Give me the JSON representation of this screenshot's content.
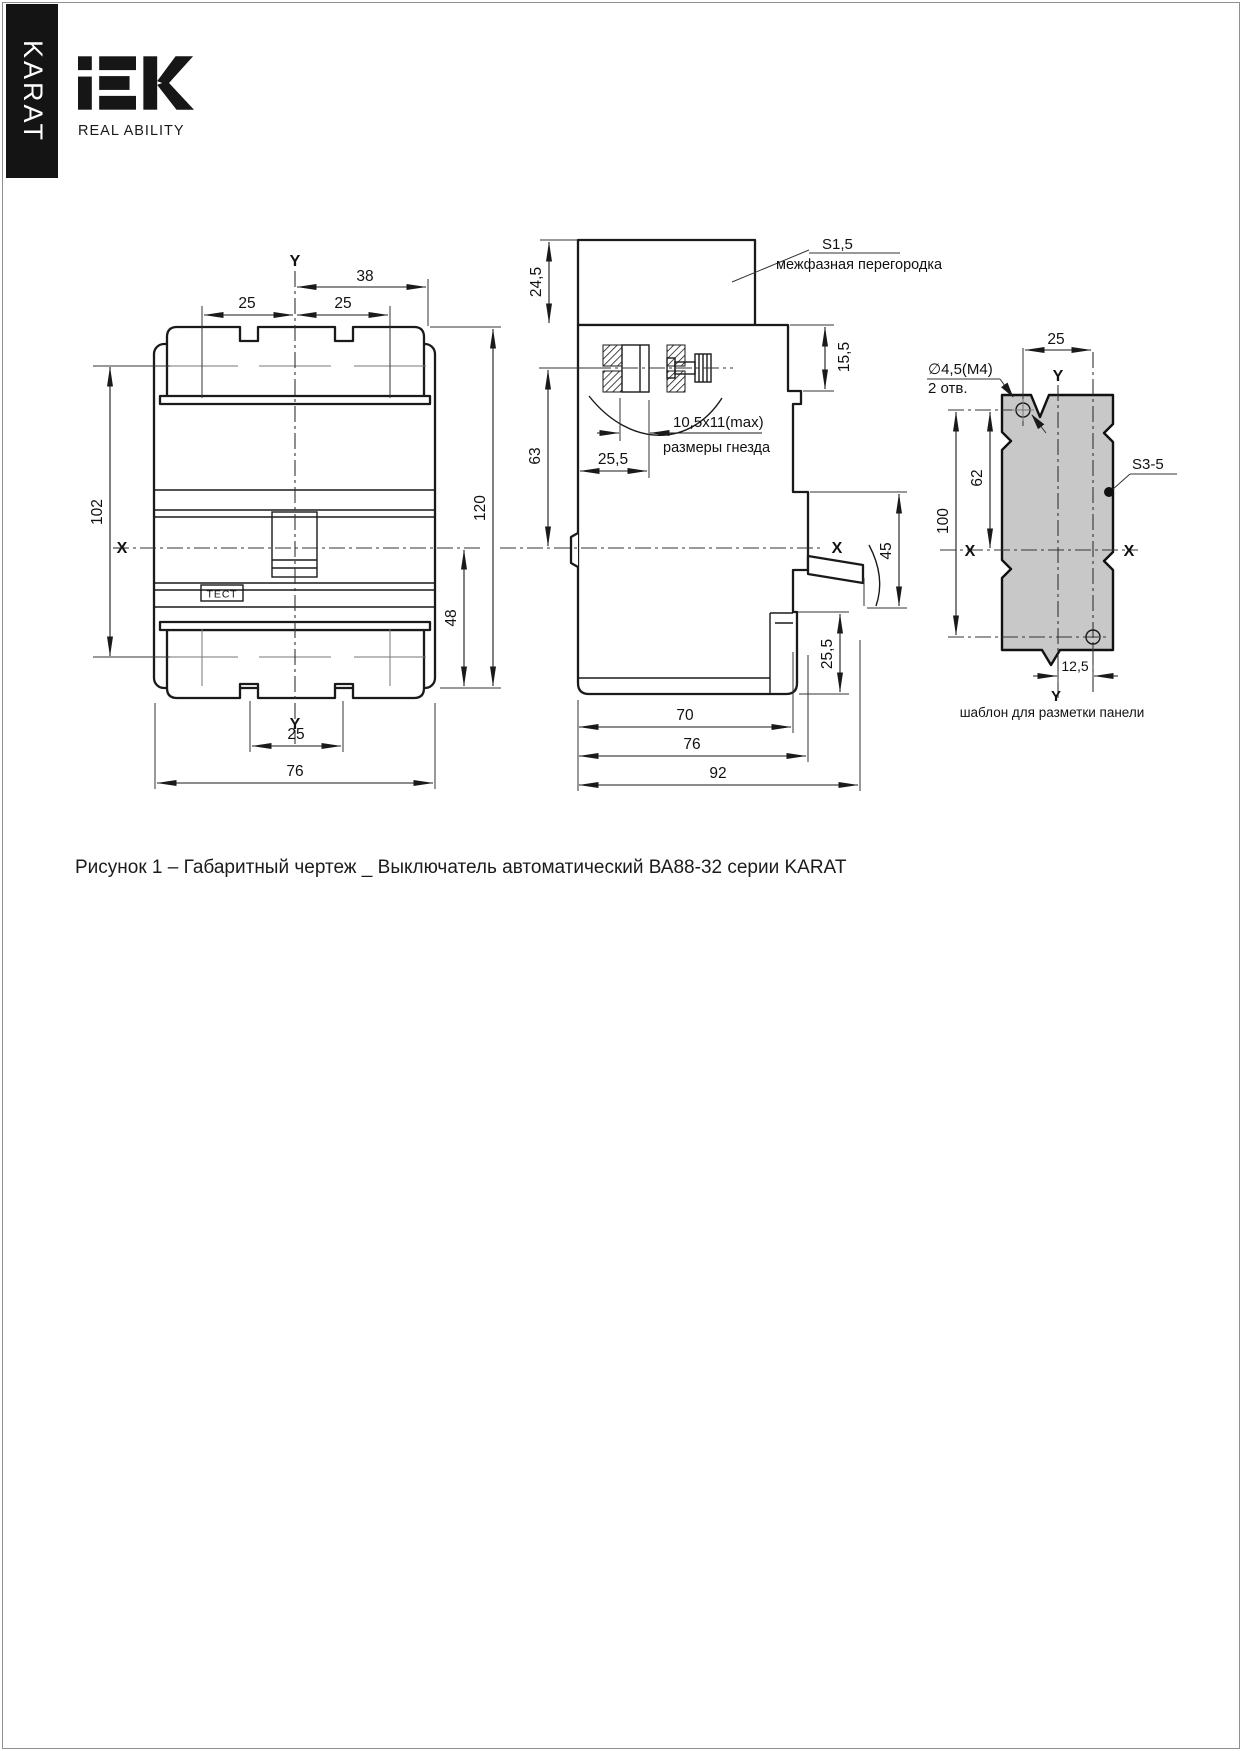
{
  "branding": {
    "vertical_banner": "KARAT",
    "logo_text": "IEK",
    "tagline": "REAL ABILITY"
  },
  "figure": {
    "caption": "Рисунок 1 – Габаритный чертеж _ Выключатель автоматический ВА88-32 серии KARAT"
  },
  "front_view": {
    "axis_y_top": "Y",
    "axis_y_bottom": "Y",
    "axis_x": "X",
    "dim_width_half": "38",
    "dim_pole_pitch_left": "25",
    "dim_pole_pitch_right": "25",
    "dim_height_upper": "102",
    "dim_height_total": "120",
    "dim_height_lower": "48",
    "dim_notch_pitch": "25",
    "dim_width_total": "76",
    "test_button_label": "ТЕСТ"
  },
  "side_view": {
    "dim_barrier_height": "24,5",
    "barrier_thickness": "S1,5",
    "barrier_name": "межфазная перегородка",
    "dim_terminal_depth": "15,5",
    "dim_terminal_axis": "63",
    "socket_size": "10,5x11(max)",
    "socket_caption": "размеры гнезда",
    "dim_socket_offset": "25,5",
    "axis_x": "X",
    "dim_handle_travel": "45",
    "dim_mount_step": "25,5",
    "dim_depth_body": "70",
    "dim_depth_base": "76",
    "dim_depth_total": "92"
  },
  "template_view": {
    "dim_hole_offset_x": "25",
    "axis_y_top": "Y",
    "axis_y_bottom": "Y",
    "axis_x_left": "X",
    "axis_x_right": "X",
    "hole_diameter": "∅4,5(M4)",
    "hole_count": "2 отв.",
    "dim_hole_to_axis": "62",
    "dim_hole_spacing": "100",
    "panel_thickness": "S3-5",
    "dim_hole_offset_y": "12,5",
    "caption": "шаблон для разметки панели"
  }
}
